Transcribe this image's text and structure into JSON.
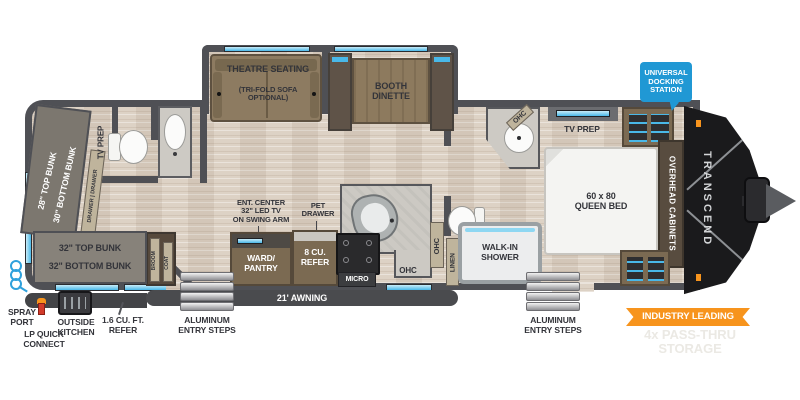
{
  "brand": "TRANSCEND",
  "callouts": {
    "docking": "UNIVERSAL\nDOCKING\nSTATION",
    "industry": "INDUSTRY LEADING",
    "storage": "4x PASS-THRU\nSTORAGE"
  },
  "labels": {
    "theatre": "THEATRE SEATING",
    "theatre_opt": "(TRI-FOLD SOFA\nOPTIONAL)",
    "booth": "BOOTH\nDINETTE",
    "bunk_left": "28\" TOP BUNK\n30\" BOTTOM BUNK",
    "drawers": "DRAWER | DRAWER",
    "tv_prep": "TV PREP",
    "bunk32": "32\" TOP BUNK\n32\" BOTTOM BUNK",
    "broom": "BROOM",
    "coat": "COAT",
    "ent_center": "ENT. CENTER\n32\" LED TV\nON SWING ARM",
    "pet_drawer": "PET\nDRAWER",
    "ward_pantry": "WARD/\nPANTRY",
    "refer8": "8 CU.\nREFER",
    "micro": "MICRO",
    "ohc": "OHC",
    "linen": "LINEN",
    "shower": "WALK-IN\nSHOWER",
    "queen_bed": "60 x 80\nQUEEN BED",
    "overhead_cabinets": "OVERHEAD CABINETS",
    "awning": "21' AWNING",
    "steps": "ALUMINUM\nENTRY STEPS",
    "spray_port": "SPRAY\nPORT",
    "lp_connect": "LP QUICK\nCONNECT",
    "outside_kitchen": "OUTSIDE\nKITCHEN",
    "refer16": "1.6 CU. FT.\nREFER"
  },
  "colors": {
    "wall": "#4f5055",
    "floor": "#ddd2c5",
    "accent_blue": "#49b8e8",
    "docking_blue": "#2098d4",
    "orange": "#f7941d",
    "cabinet_brown": "#7b6a52",
    "front_cap_black": "#1a1a1c",
    "label_text": "#33343a"
  }
}
